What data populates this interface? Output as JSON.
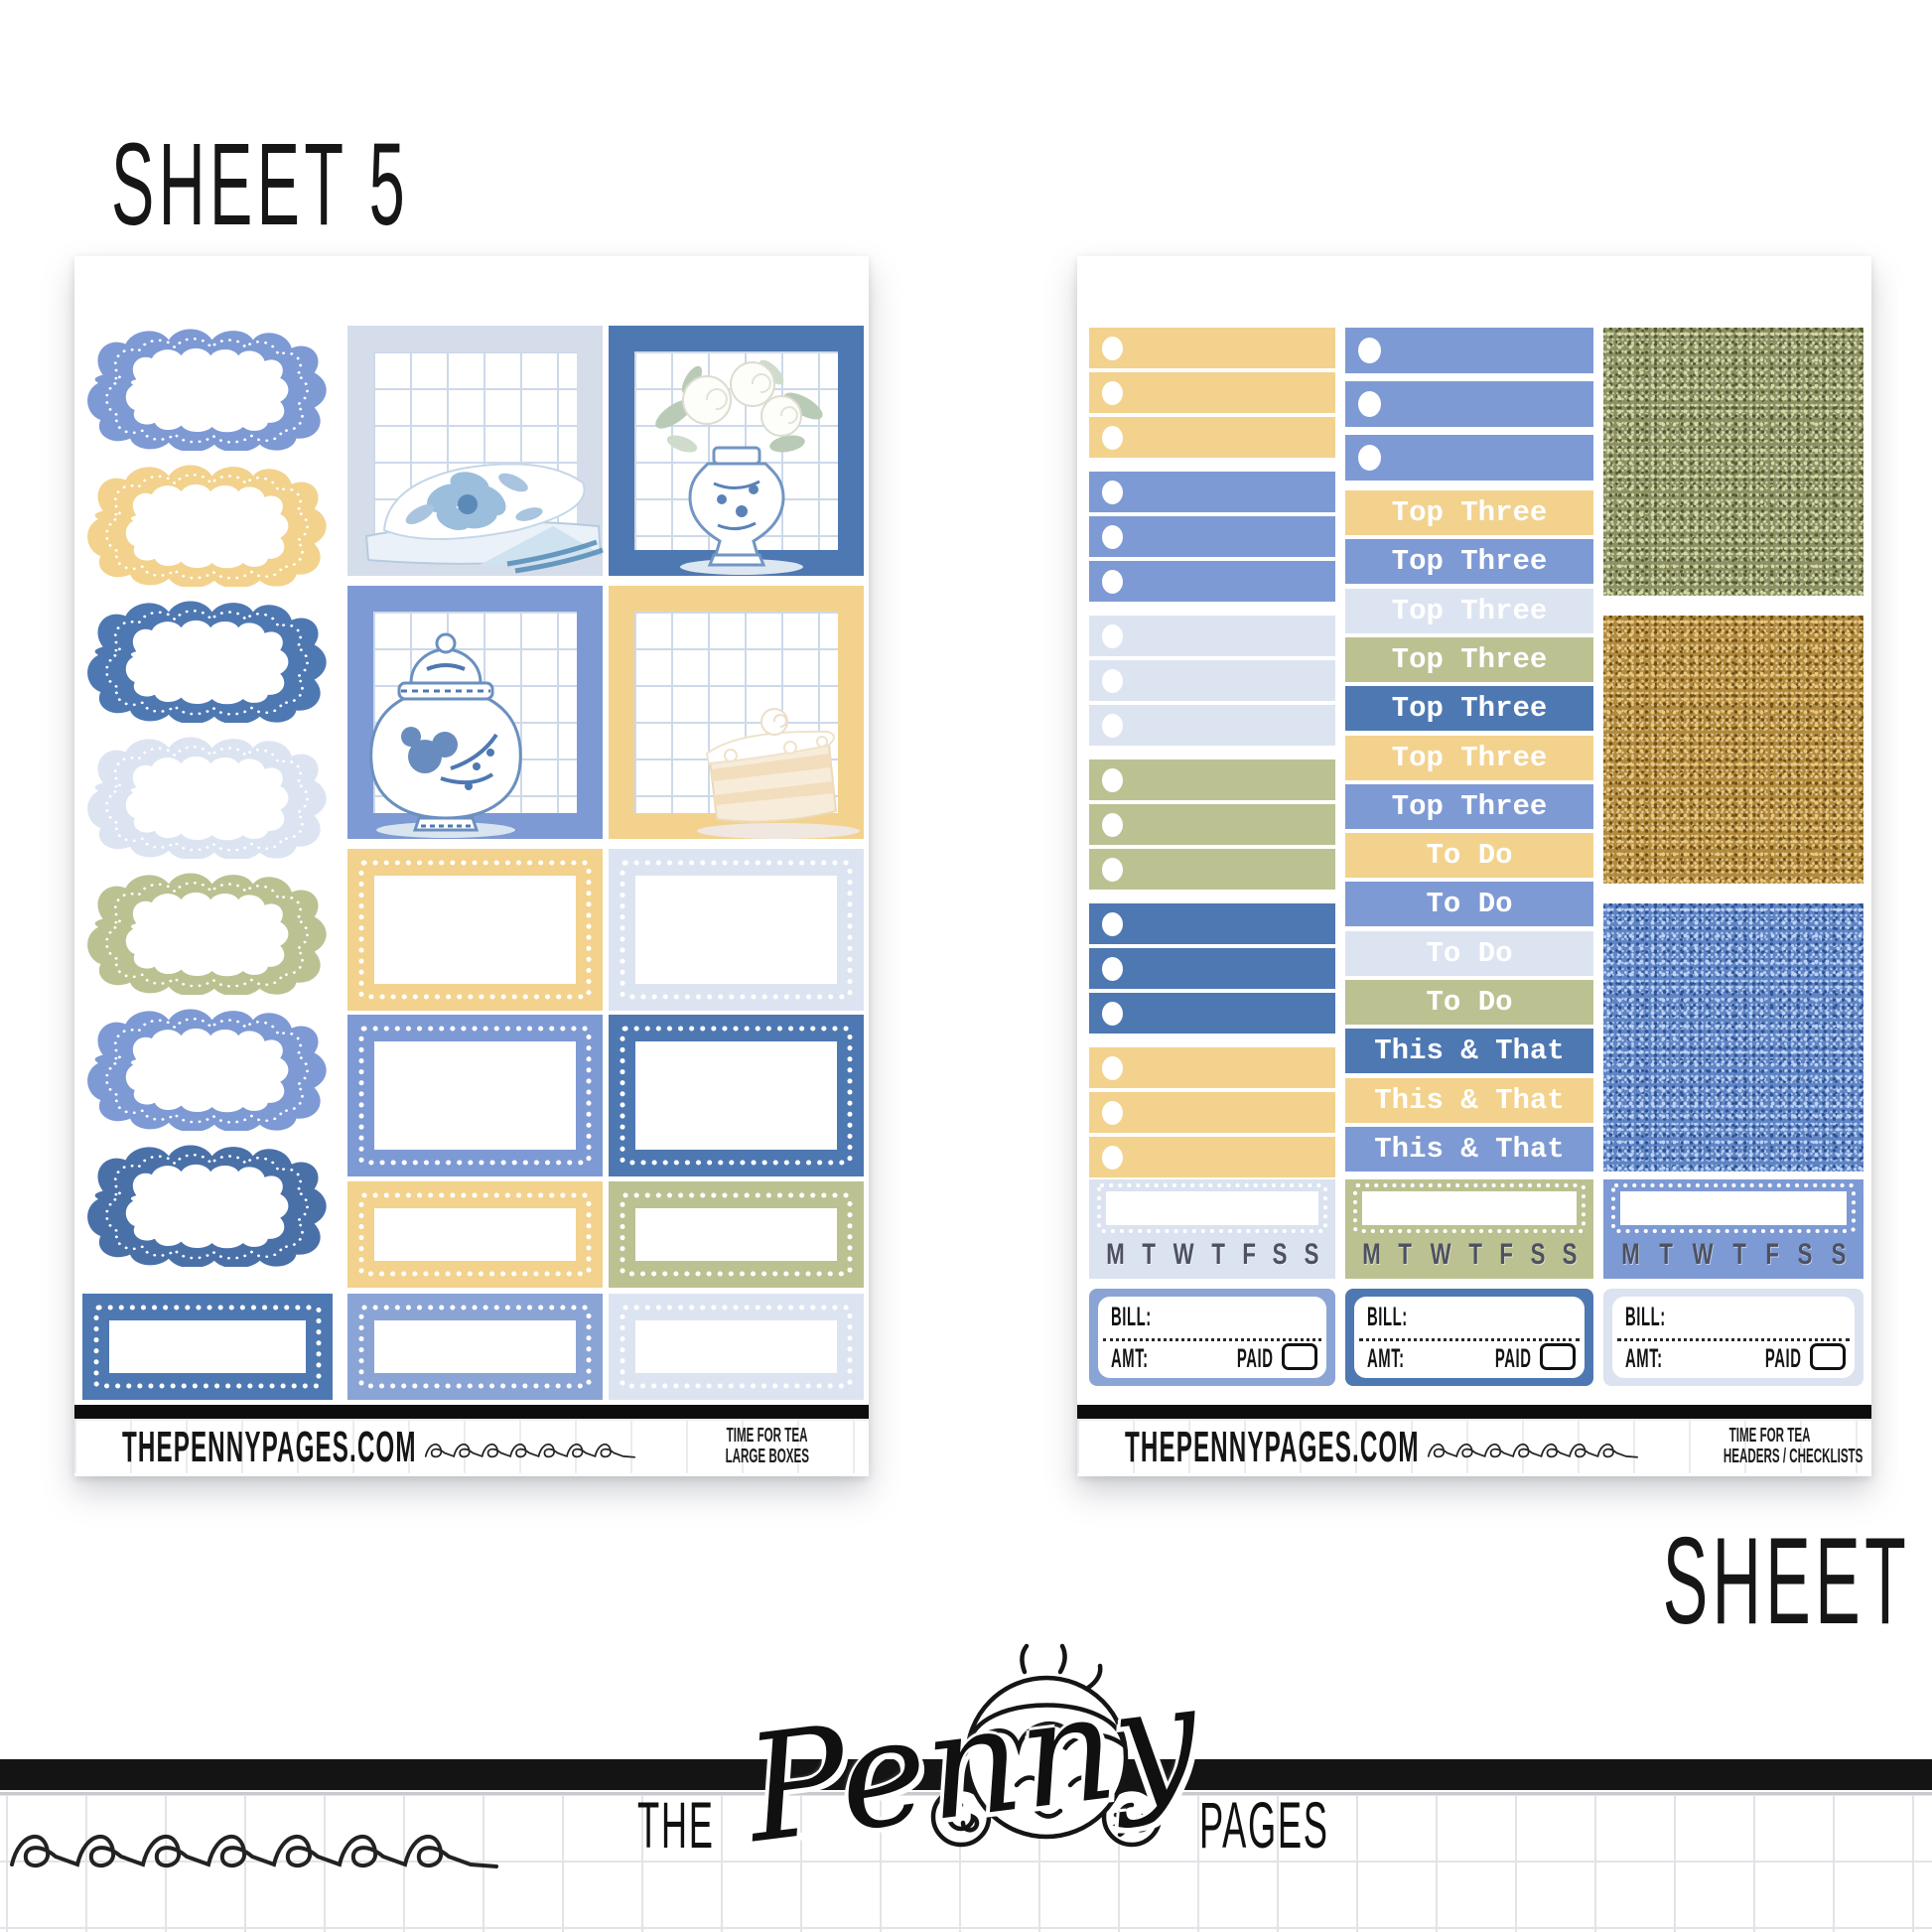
{
  "titles": {
    "sheet5": "SHEET 5",
    "sheet6": "SHEET 6"
  },
  "brand": {
    "site": "THEPENNYPAGES.COM"
  },
  "logo": {
    "the": "THE",
    "penny": "Penny",
    "pages": "PAGES"
  },
  "sheet5": {
    "footer": {
      "line1": "TIME FOR TEA",
      "line2": "LARGE BOXES"
    },
    "clouds": [
      {
        "color": "#7e9ad4"
      },
      {
        "color": "#f2d28d"
      },
      {
        "color": "#4e78b2"
      },
      {
        "color": "#dde4f1"
      },
      {
        "color": "#bcc192"
      },
      {
        "color": "#7e9ad4"
      },
      {
        "color": "#4a70a8"
      }
    ],
    "full_boxes": [
      {
        "frame": "#d5ddeb",
        "illustration": "napkins"
      },
      {
        "frame": "#4e78b2",
        "illustration": "vase"
      },
      {
        "frame": "#7e9ad4",
        "illustration": "jar"
      },
      {
        "frame": "#f2d28d",
        "illustration": "cake"
      }
    ],
    "half_box_rows": [
      {
        "colors": [
          "#f2d28d",
          "#dde4f1"
        ]
      },
      {
        "colors": [
          "#7e9ad4",
          "#4e78b2"
        ]
      },
      {
        "colors": [
          "#f2d28d",
          "#bcc192"
        ]
      }
    ],
    "bottom_boxes": [
      {
        "color": "#4e78b2"
      },
      {
        "color": "#8aa4d6"
      },
      {
        "color": "#dde4f1"
      }
    ]
  },
  "sheet6": {
    "footer": {
      "line1": "TIME FOR TEA",
      "line2": "HEADERS / CHECKLISTS"
    },
    "checklist_groups": [
      {
        "color": "#f2d28d"
      },
      {
        "color": "#7e9ad4"
      },
      {
        "color": "#dde4f1"
      },
      {
        "color": "#bcc192"
      },
      {
        "color": "#4e78b2"
      },
      {
        "color": "#f2d28d"
      }
    ],
    "bullet_strips": {
      "color": "#7e9ad4",
      "count": 3
    },
    "headers": [
      {
        "label": "Top Three",
        "color": "#f2d28d"
      },
      {
        "label": "Top Three",
        "color": "#7e9ad4"
      },
      {
        "label": "Top Three",
        "color": "#dde4f1"
      },
      {
        "label": "Top Three",
        "color": "#bcc192"
      },
      {
        "label": "Top Three",
        "color": "#4e78b2"
      },
      {
        "label": "Top Three",
        "color": "#f2d28d"
      },
      {
        "label": "Top Three",
        "color": "#7e9ad4"
      },
      {
        "label": "To Do",
        "color": "#f2d28d"
      },
      {
        "label": "To Do",
        "color": "#7e9ad4"
      },
      {
        "label": "To Do",
        "color": "#dde4f1"
      },
      {
        "label": "To Do",
        "color": "#bcc192"
      },
      {
        "label": "This & That",
        "color": "#4e78b2"
      },
      {
        "label": "This & That",
        "color": "#f2d28d"
      },
      {
        "label": "This & That",
        "color": "#7e9ad4"
      }
    ],
    "glitters": [
      {
        "name": "green-glitter",
        "base": "#8d9162",
        "light": "#d3daa6",
        "dark": "#54582f"
      },
      {
        "name": "gold-glitter",
        "base": "#b28a3c",
        "light": "#e9c87e",
        "dark": "#6e4f15"
      },
      {
        "name": "blue-glitter",
        "base": "#5d84c6",
        "light": "#bdd3f5",
        "dark": "#2f5190"
      }
    ],
    "days": [
      "M",
      "T",
      "W",
      "T",
      "F",
      "S",
      "S"
    ],
    "habit_trackers": [
      {
        "bg": "#dbe2f0"
      },
      {
        "bg": "#bcc192"
      },
      {
        "bg": "#7e9ad4"
      }
    ],
    "bill": {
      "bill_label": "BILL:",
      "amt_label": "AMT:",
      "paid_label": "PAID"
    },
    "bill_trackers": [
      {
        "bg": "#8aa4d6"
      },
      {
        "bg": "#4e78b2"
      },
      {
        "bg": "#dbe2f0"
      }
    ]
  }
}
